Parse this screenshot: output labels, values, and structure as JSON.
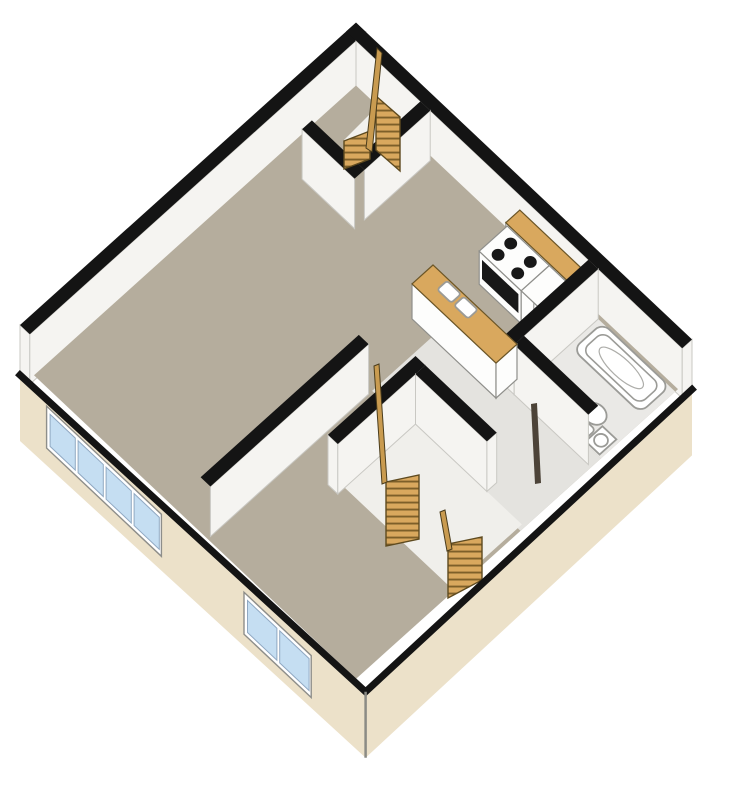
{
  "image": {
    "type": "3d-isometric-floor-plan",
    "description": "Cutaway axonometric (dollhouse) floor plan of an apartment level, rotated 45 degrees into a diamond shape",
    "width": 750,
    "height": 795
  },
  "colors": {
    "background": "#FFFFFF",
    "outline": "#141414",
    "wall_face": "#F5F4F1",
    "floor": "#B5AD9D",
    "floor_hall": "#E4E3DF",
    "floor_bathroom": "#EAE9E6",
    "exterior_slab": "#ECE1C9",
    "wood_counter": "#D9A85E",
    "stair_stripe": "#7D5F29",
    "window_blue": "#C5DEF2",
    "fixture_stroke": "#9B9B97",
    "appliance_black": "#181818",
    "door_leaf": "#4C4338",
    "stair_hole": "#F0EFEB"
  },
  "rooms": [
    {
      "name": "living-room",
      "position": "left"
    },
    {
      "name": "kitchen",
      "position": "upper-right"
    },
    {
      "name": "bathroom",
      "position": "right-corner"
    },
    {
      "name": "bedroom",
      "position": "lower-left"
    },
    {
      "name": "hallway",
      "position": "lower-center"
    },
    {
      "name": "upper-stairwell",
      "position": "top-corner",
      "flights": 2
    },
    {
      "name": "lower-stairwell",
      "position": "bottom-center",
      "flights": 2
    }
  ],
  "fixtures": [
    "stove-with-4-burners-and-oven",
    "wood-countertop-along-wall",
    "kitchen-peninsula-with-double-sink",
    "bathtub",
    "toilet",
    "bathroom-sink",
    "open-bathroom-door",
    "stair-railings"
  ],
  "windows": [
    {
      "location": "lower-left-exterior-wall",
      "panes": 4
    },
    {
      "location": "lower-left-exterior-wall-near-bottom",
      "panes": 2
    }
  ]
}
